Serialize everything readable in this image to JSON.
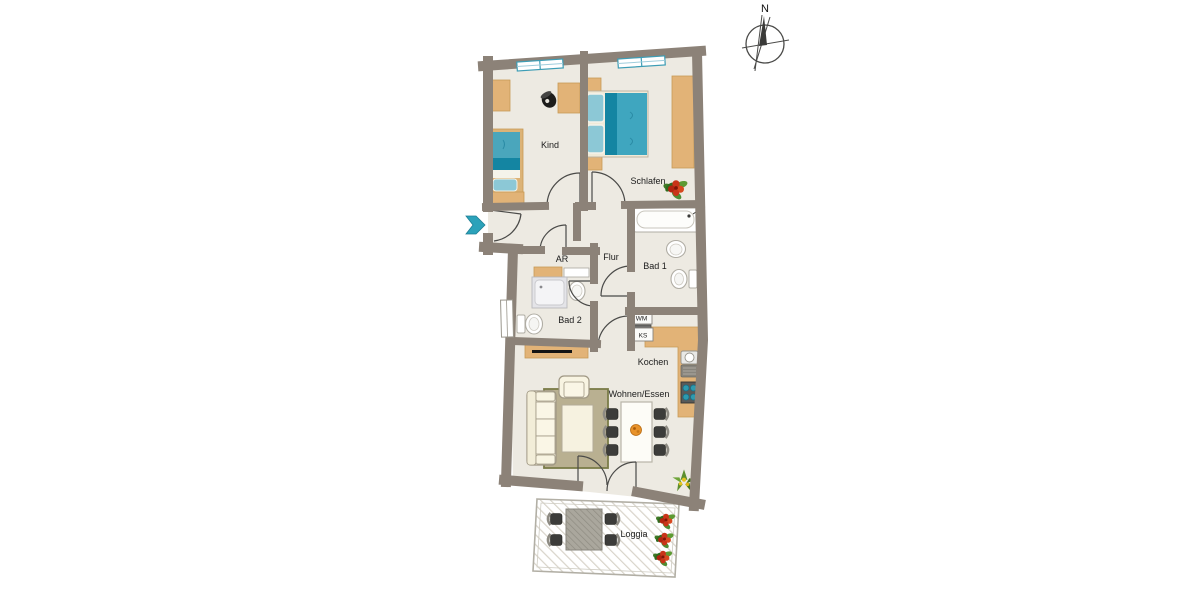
{
  "plan": {
    "type": "apartment-floor-plan",
    "compass": {
      "north_label": "N"
    },
    "rooms": {
      "kind": "Kind",
      "schlafen": "Schlafen",
      "flur": "Flur",
      "ar": "AR",
      "bad1": "Bad 1",
      "bad2": "Bad 2",
      "kochen": "Kochen",
      "wohnen_essen": "Wohnen/Essen",
      "loggia": "Loggia"
    },
    "appliances": {
      "washing_machine": "WM",
      "fridge": "KS"
    },
    "colors": {
      "wall": "#8c8278",
      "floor": "#edeae2",
      "furniture_wood": "#e2b377",
      "bed_teal": "#3fa6bf",
      "bed_teal_dark": "#1485a2",
      "bed_teal_light": "#8cc8d6",
      "window_frame": "#3d9db5",
      "entrance_arrow": "#2ba2ba",
      "rug": "#b9b091",
      "rug_border": "#7a7c48",
      "cream_furniture": "#f8f4e2",
      "plant_red": "#c93418",
      "plant_green": "#4e8d33"
    }
  }
}
